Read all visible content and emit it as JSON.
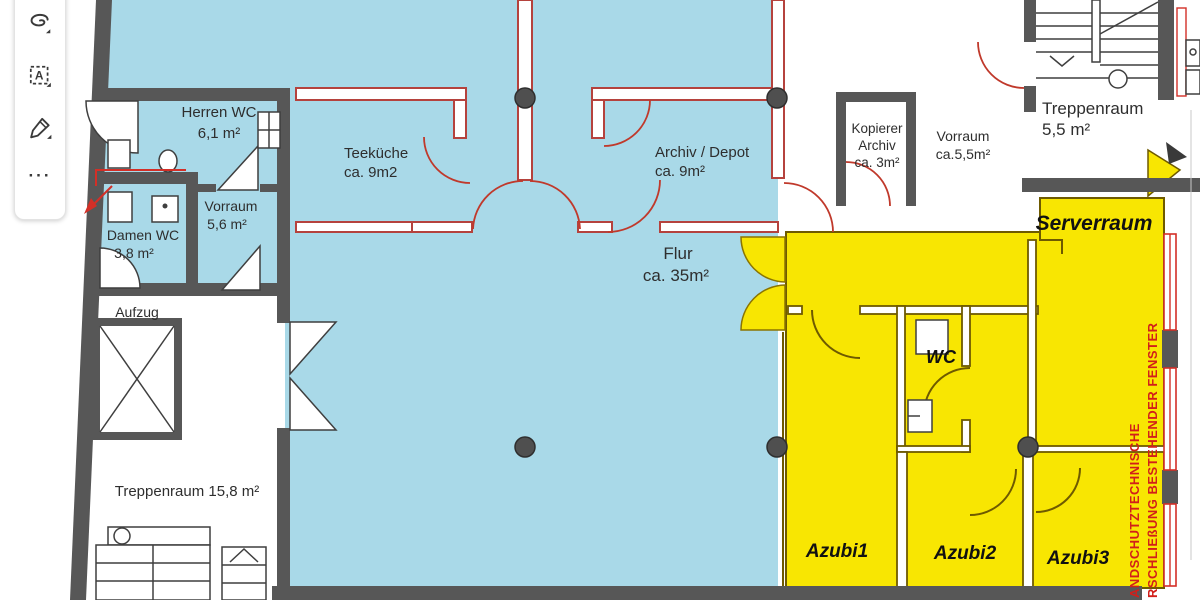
{
  "toolbar": {
    "buttons": [
      {
        "name": "freeform-select"
      },
      {
        "name": "text-select"
      },
      {
        "name": "pen-annotate"
      },
      {
        "name": "more-options"
      }
    ],
    "text_select_letter": "A",
    "more_glyph": "···"
  },
  "floorplan": {
    "rooms": {
      "herren_wc": {
        "name": "Herren WC",
        "area": "6,1 m²"
      },
      "damen_wc": {
        "name": "Damen WC",
        "area": "3,8 m²"
      },
      "vorraum_wc": {
        "name": "Vorraum",
        "area": "5,6 m²"
      },
      "teekueche": {
        "name": "Teeküche",
        "area": "ca. 9m2"
      },
      "archiv": {
        "name": "Archiv / Depot",
        "area": "ca. 9m²"
      },
      "flur": {
        "name": "Flur",
        "area": "ca. 35m²"
      },
      "kopierer": {
        "name": "Kopierer",
        "name2": "Archiv",
        "area": "ca. 3m²"
      },
      "vorraum_top": {
        "name": "Vorraum",
        "area": "ca.5,5m²"
      },
      "treppenraum_top": {
        "name": "Treppenraum",
        "area": "5,5 m²"
      },
      "serverraum": {
        "name": "Serverraum"
      },
      "wc_yellow": {
        "name": "WC"
      },
      "aufzug": {
        "name": "Aufzug"
      },
      "treppenraum_bottom": {
        "name": "Treppenraum 15,8 m²"
      },
      "azubi1": {
        "name": "Azubi1"
      },
      "azubi2": {
        "name": "Azubi2"
      },
      "azubi3": {
        "name": "Azubi3"
      }
    },
    "annotations": {
      "fire_note_line1": "ANDSCHUTZTECHNISCHE",
      "fire_note_line2": "RSCHLIEßUNG BESTEHENDER FENSTER"
    },
    "colors": {
      "room_blue": "#a9d9e8",
      "room_yellow": "#f8e602",
      "wall_gray": "#575757",
      "marking_red": "#d32f27",
      "partition_red": "#b5423d",
      "yellow_outline": "#6e5a00"
    }
  }
}
